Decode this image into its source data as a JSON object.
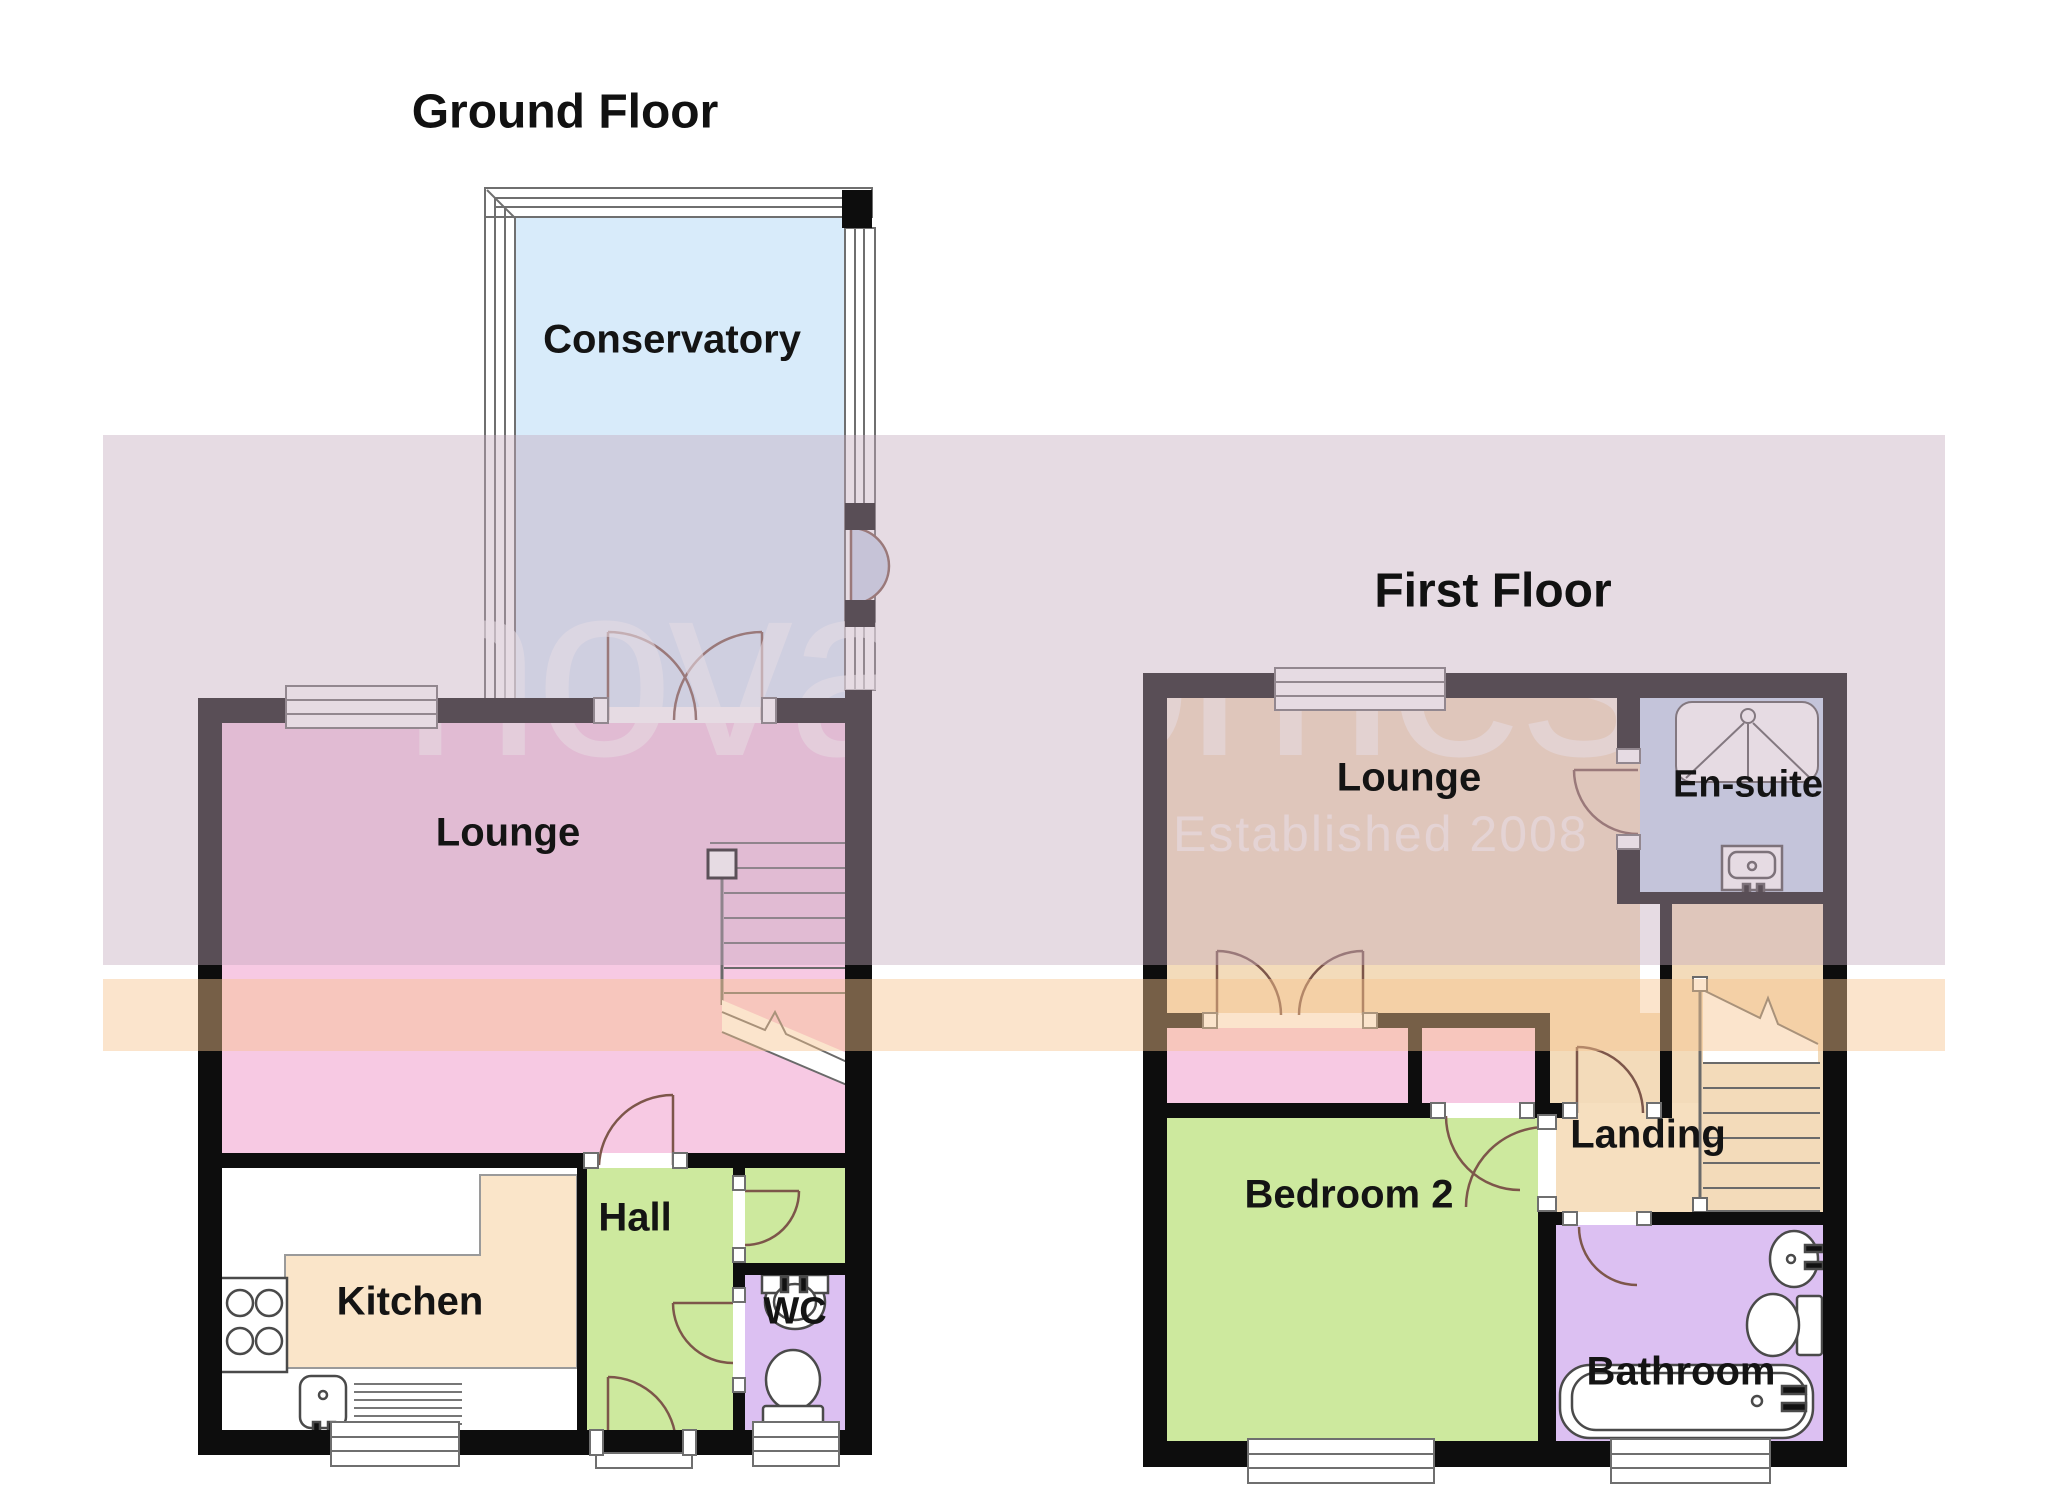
{
  "document": {
    "type": "estate-agent floor plan",
    "background": "#ffffff"
  },
  "watermark": {
    "brand": "novahomes",
    "tagline": "Established 2008",
    "brand_color": "rgba(255,255,255,0.55)",
    "band_pink": "rgba(196,170,188,0.42)",
    "band_orange": "rgba(246,195,141,0.45)"
  },
  "ground_floor": {
    "title": "Ground Floor",
    "rooms": {
      "conservatory": "Conservatory",
      "lounge": "Lounge",
      "kitchen": "Kitchen",
      "hall": "Hall",
      "wc": "WC"
    }
  },
  "first_floor": {
    "title": "First Floor",
    "rooms": {
      "lounge": "Lounge",
      "ensuite": "En-suite",
      "landing": "Landing",
      "bedroom2": "Bedroom 2",
      "bathroom": "Bathroom"
    }
  },
  "palette": {
    "wall": "#0d0d0d",
    "conservatory_blue": "#D8EBFA",
    "pink_room": "#F7C9E3",
    "kitchen_tan": "#FAE5C9",
    "green_room": "#CDE99E",
    "purple_room": "#DCC0F2",
    "first_floor_tan": "#F3DBBA",
    "ensuite_blue": "#C4D7F0",
    "door_arc": "#7d564a"
  }
}
